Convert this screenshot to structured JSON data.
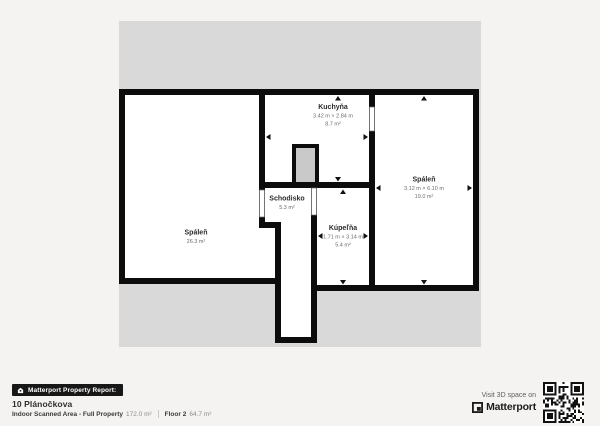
{
  "page": {
    "background": "#f4f3f2"
  },
  "floorplan": {
    "footprint_color": "#d9d9d9",
    "wall_color": "#0c0c0c",
    "room_fill": "#ffffff",
    "chimney_fill": "#c9c9c9",
    "rooms": {
      "kitchen": {
        "name": "Kuchyňa",
        "dims": "3.42 m × 2.84 m",
        "area": "8.7 m²"
      },
      "bedroom_right": {
        "name": "Spáleň",
        "dims": "3.12 m × 6.10 m",
        "area": "19.0 m²"
      },
      "staircase": {
        "name": "Schodisko",
        "area": "5.3 m²"
      },
      "bathroom": {
        "name": "Kúpeľňa",
        "dims": "1.71 m × 3.14 m",
        "area": "5.4 m²"
      },
      "bedroom_left": {
        "name": "Spáleň",
        "area": "26.3 m²"
      }
    }
  },
  "footer": {
    "report_bar_label": "Matterport Property Report:",
    "address": "10 Plánočkova",
    "scanned_area_label": "Indoor Scanned Area - Full Property",
    "scanned_area_value": "172.0 m²",
    "floor_label": "Floor 2",
    "floor_value": "64.7 m²"
  },
  "cta": {
    "visit_text": "Visit 3D space on",
    "brand": "Matterport"
  }
}
